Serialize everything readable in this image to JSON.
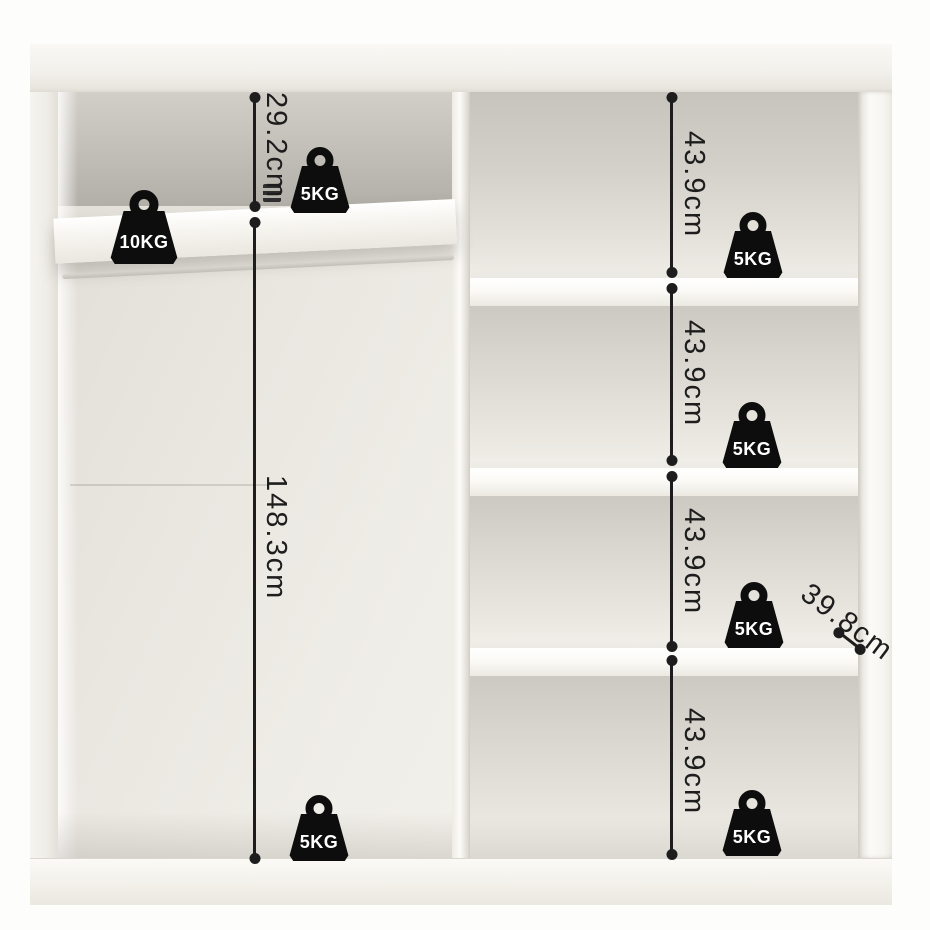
{
  "dimensions": {
    "left_top": "29.2cm",
    "left_height": "148.3cm",
    "right_sections": [
      "43.9cm",
      "43.9cm",
      "43.9cm",
      "43.9cm"
    ],
    "depth": "39.8cm"
  },
  "weight_capacities": {
    "left_shelf": "10KG",
    "left_top_shelf": "5KG",
    "right_shelf_1": "5KG",
    "right_shelf_2": "5KG",
    "right_shelf_3": "5KG",
    "right_bottom": "5KG",
    "left_bottom": "5KG"
  },
  "colors": {
    "annotation": "#1d1d1d",
    "weight_icon": "#0d0d0d",
    "weight_text": "#ffffff",
    "cabinet_white": "#f6f4ef",
    "interior_shadow": "#b8b5ae",
    "background": "#fdfdfc"
  }
}
